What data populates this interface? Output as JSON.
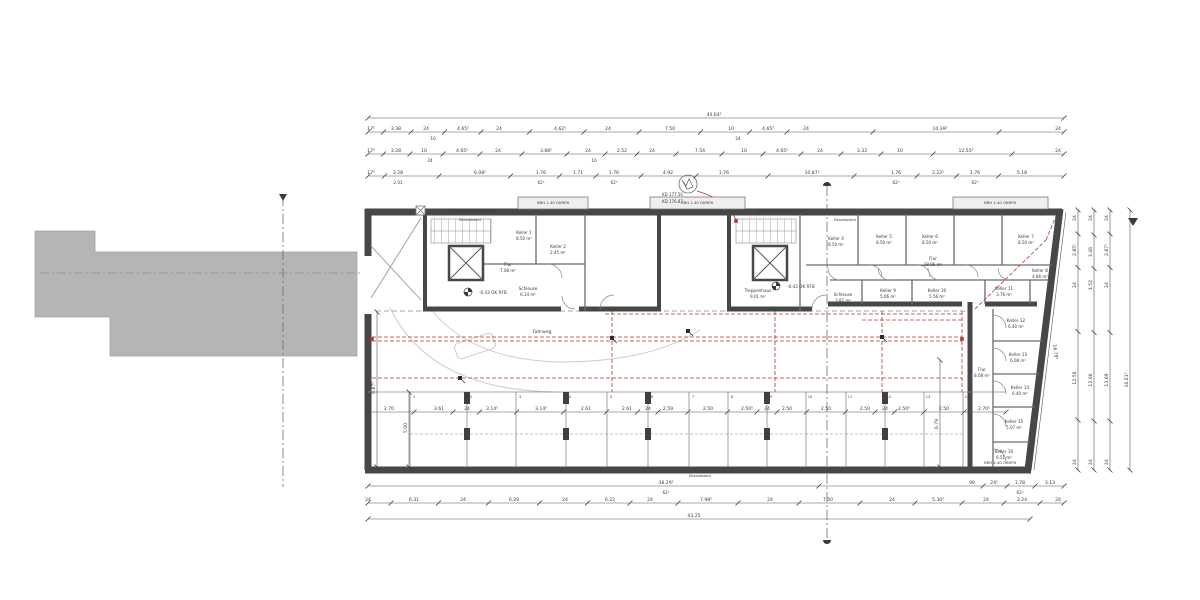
{
  "palette": {
    "wall": "#474747",
    "thin": "#6a6a6a",
    "line": "#8a8a8a",
    "dim_text": "#3a3a3a",
    "red": "#b03a2e",
    "gray_mass": "#b5b5b5",
    "light_arc": "#cccccc",
    "window_fill": "#efefef"
  },
  "rooms": [
    {
      "name": "Keller 1",
      "area": "8.50 m²",
      "x": 524,
      "y": 234
    },
    {
      "name": "Keller 2",
      "area": "2.45 m²",
      "x": 558,
      "y": 248
    },
    {
      "name": "Flur",
      "area": "7.08 m²",
      "x": 508,
      "y": 266
    },
    {
      "name": "Schleuse",
      "area": "6.14 m²",
      "x": 528,
      "y": 290
    },
    {
      "name": "Treppenhaus",
      "area": "9.01 m²",
      "x": 758,
      "y": 292
    },
    {
      "name": "Schleuse",
      "area": "3.87 m²",
      "x": 843,
      "y": 296
    },
    {
      "name": "Keller 4",
      "area": "8.50 m²",
      "x": 836,
      "y": 240
    },
    {
      "name": "Keller 5",
      "area": "8.50 m²",
      "x": 884,
      "y": 238
    },
    {
      "name": "Keller 6",
      "area": "8.50 m²",
      "x": 930,
      "y": 238
    },
    {
      "name": "Keller 7",
      "area": "8.50 m²",
      "x": 1026,
      "y": 238
    },
    {
      "name": "Keller 8",
      "area": "4.86 m²",
      "x": 1040,
      "y": 272
    },
    {
      "name": "Keller 9",
      "area": "5.06 m²",
      "x": 888,
      "y": 292
    },
    {
      "name": "Keller 10",
      "area": "5.56 m²",
      "x": 937,
      "y": 292
    },
    {
      "name": "Keller 11",
      "area": "3.76 m²",
      "x": 1004,
      "y": 290
    },
    {
      "name": "Flur",
      "area": "18.96 m²",
      "x": 933,
      "y": 260
    },
    {
      "name": "Keller 12",
      "area": "6.40 m²",
      "x": 1016,
      "y": 322
    },
    {
      "name": "Keller 13",
      "area": "6.08 m²",
      "x": 1018,
      "y": 356
    },
    {
      "name": "Keller 14",
      "area": "6.40 m²",
      "x": 1020,
      "y": 389
    },
    {
      "name": "Keller 15",
      "area": "5.07 m²",
      "x": 1014,
      "y": 423
    },
    {
      "name": "Keller 16",
      "area": "6.51 m²",
      "x": 1004,
      "y": 453
    },
    {
      "name": "Flur",
      "area": "8.08 m²",
      "x": 982,
      "y": 371
    }
  ],
  "annotations": [
    {
      "t": "Sicherheitstreppenraum",
      "x": 450,
      "y": 212,
      "s": 4.2,
      "a": "start",
      "c": "#4a4a4a"
    },
    {
      "t": "Sicherheitstreppenraum",
      "x": 757,
      "y": 212,
      "s": 4.2,
      "a": "start",
      "c": "#4a4a4a"
    },
    {
      "t": "BRH 1.40 OKRFB",
      "x": 553,
      "y": 204,
      "s": 3.8,
      "a": "middle",
      "c": "#5a5a5a"
    },
    {
      "t": "BRH 1.40 OKRFB",
      "x": 697,
      "y": 204,
      "s": 3.8,
      "a": "middle",
      "c": "#5a5a5a"
    },
    {
      "t": "BRH 1.40 OKRFB",
      "x": 1000,
      "y": 204,
      "s": 3.8,
      "a": "middle",
      "c": "#5a5a5a"
    },
    {
      "t": "BRH 1.40 OKRFB",
      "x": 1000,
      "y": 464,
      "s": 3.8,
      "a": "middle",
      "c": "#5a5a5a"
    },
    {
      "t": "Brandwand",
      "x": 470,
      "y": 221,
      "s": 3.8,
      "a": "middle",
      "c": "#bdbdbd"
    },
    {
      "t": "Brandwand",
      "x": 845,
      "y": 221,
      "s": 3.8,
      "a": "middle",
      "c": "#bdbdbd"
    },
    {
      "t": "Brandwand",
      "x": 700,
      "y": 477,
      "s": 3.8,
      "a": "middle",
      "c": "#bdbdbd"
    },
    {
      "t": "-0.43 OK RFB",
      "x": 479,
      "y": 294,
      "s": 4.2,
      "a": "start",
      "c": "#3a3a3a"
    },
    {
      "t": "-0.43 OK RFB",
      "x": 787,
      "y": 288,
      "s": 4.2,
      "a": "start",
      "c": "#3a3a3a"
    },
    {
      "t": "KD 177.50",
      "x": 662,
      "y": 196,
      "s": 4,
      "a": "start",
      "c": "#b03a2e"
    },
    {
      "t": "KD 176.87",
      "x": 662,
      "y": 203,
      "s": 4,
      "a": "start",
      "c": "#b03a2e"
    },
    {
      "t": "Fahrweg",
      "x": 542,
      "y": 333,
      "s": 4.5,
      "a": "middle",
      "c": "#4a4a4a"
    }
  ],
  "dims": {
    "h_rows": [
      {
        "y": 118,
        "x1": 368,
        "x2": 1064,
        "labels": [
          [
            "44.64⁵",
            714
          ]
        ]
      },
      {
        "y": 132,
        "x1": 368,
        "x2": 1064,
        "labels": [
          [
            "17⁵",
            371
          ],
          [
            "3.38",
            396
          ],
          [
            "24",
            426
          ],
          [
            "4.65⁵",
            463
          ],
          [
            "24",
            499
          ],
          [
            "4.62⁵",
            560
          ],
          [
            "24",
            608
          ],
          [
            "7.50",
            670
          ],
          [
            "10",
            731
          ],
          [
            "4.65⁵",
            768
          ],
          [
            "24",
            806
          ],
          [
            "10.39⁵",
            940
          ],
          [
            "24",
            1058
          ]
        ]
      },
      {
        "y": 154,
        "x1": 368,
        "x2": 1064,
        "labels": [
          [
            "17⁵",
            371
          ],
          [
            "3.28",
            396
          ],
          [
            "10",
            424
          ],
          [
            "4.65⁵",
            462
          ],
          [
            "24",
            498
          ],
          [
            "3.88⁵",
            546
          ],
          [
            "24",
            588
          ],
          [
            "2.52",
            622
          ],
          [
            "24",
            652
          ],
          [
            "7.54",
            700
          ],
          [
            "10",
            744
          ],
          [
            "4.65⁵",
            782
          ],
          [
            "24",
            820
          ],
          [
            "3.33",
            862
          ],
          [
            "10",
            900
          ],
          [
            "12.55⁵",
            966
          ],
          [
            "24",
            1058
          ]
        ]
      },
      {
        "y": 176,
        "x1": 368,
        "x2": 1064,
        "labels": [
          [
            "17⁵",
            371
          ],
          [
            "3.28",
            398
          ],
          [
            "6.08⁵",
            480
          ],
          [
            "1.76",
            541
          ],
          [
            "1.71",
            578
          ],
          [
            "1.76",
            614
          ],
          [
            "4.92",
            668
          ],
          [
            "1.76",
            724
          ],
          [
            "10.87⁵",
            812
          ],
          [
            "1.76",
            896
          ],
          [
            "2.22⁵",
            938
          ],
          [
            "1.76",
            975
          ],
          [
            "5.18",
            1022
          ]
        ]
      },
      {
        "y": 412,
        "x1": 368,
        "x2": 1006,
        "labels": [
          [
            "2.70",
            389
          ],
          [
            "3.61",
            439
          ],
          [
            "24",
            467
          ],
          [
            "3.14⁵",
            492
          ],
          [
            "3.14⁵",
            541
          ],
          [
            "2.61",
            586
          ],
          [
            "2.61",
            627
          ],
          [
            "24",
            648
          ],
          [
            "2.59",
            668
          ],
          [
            "2.50",
            708
          ],
          [
            "2.50⁵",
            747
          ],
          [
            "24",
            767
          ],
          [
            "2.50",
            787
          ],
          [
            "2.50",
            826
          ],
          [
            "2.50",
            865
          ],
          [
            "24",
            885
          ],
          [
            "2.50⁵",
            904
          ],
          [
            "2.50",
            944
          ],
          [
            "2.70⁵",
            984
          ]
        ]
      },
      {
        "y": 486,
        "x1": 368,
        "x2": 1064,
        "labels": [
          [
            "38.29⁵",
            666
          ],
          [
            "98",
            972
          ],
          [
            "24¹",
            994
          ],
          [
            "1.78",
            1020
          ],
          [
            "3.13",
            1050
          ]
        ]
      },
      {
        "y": 503,
        "x1": 368,
        "x2": 1064,
        "labels": [
          [
            "24",
            368
          ],
          [
            "6.31",
            414
          ],
          [
            "24",
            463
          ],
          [
            "6.29",
            514
          ],
          [
            "24",
            565
          ],
          [
            "6.22",
            610
          ],
          [
            "24",
            650
          ],
          [
            "7.98⁵",
            706
          ],
          [
            "24",
            770
          ],
          [
            "7.50",
            828
          ],
          [
            "24",
            892
          ],
          [
            "5.30⁵",
            938
          ],
          [
            "24",
            986
          ],
          [
            "3.24",
            1022
          ],
          [
            "24",
            1058
          ]
        ]
      },
      {
        "y": 519,
        "x1": 368,
        "x2": 1030,
        "labels": [
          [
            "43.25",
            694
          ]
        ]
      }
    ],
    "sub_labels": [
      [
        "10",
        433,
        140
      ],
      [
        "24",
        738,
        140
      ],
      [
        "24",
        430,
        162
      ],
      [
        "10",
        594,
        162
      ],
      [
        "2.01",
        398,
        184
      ],
      [
        "62⁵",
        541,
        184
      ],
      [
        "62⁵",
        614,
        184
      ],
      [
        "62⁵",
        896,
        184
      ],
      [
        "62⁵",
        975,
        184
      ],
      [
        "62⁵",
        666,
        494
      ],
      [
        "62⁵",
        1020,
        494
      ]
    ],
    "v_chains": [
      {
        "x": 1078,
        "y1": 210,
        "y2": 470,
        "labels": [
          [
            "24",
            218
          ],
          [
            "2.85⁵",
            250
          ],
          [
            "24",
            285
          ],
          [
            "12.56",
            378
          ],
          [
            "24",
            462
          ]
        ]
      },
      {
        "x": 1094,
        "y1": 210,
        "y2": 470,
        "labels": [
          [
            "24",
            218
          ],
          [
            "3.46",
            252
          ],
          [
            "1.52",
            285
          ],
          [
            "12.06",
            380
          ],
          [
            "24",
            462
          ]
        ]
      },
      {
        "x": 1110,
        "y1": 210,
        "y2": 470,
        "labels": [
          [
            "24",
            218
          ],
          [
            "2.87⁵",
            250
          ],
          [
            "24",
            285
          ],
          [
            "13.69",
            380
          ],
          [
            "24",
            462
          ]
        ]
      },
      {
        "x": 1130,
        "y1": 210,
        "y2": 470,
        "labels": [
          [
            "16.61⁵",
            380
          ]
        ]
      },
      {
        "x": 377,
        "y1": 312,
        "y2": 467,
        "labels": [
          [
            "9.87⁵",
            388
          ]
        ]
      },
      {
        "x": 409,
        "y1": 392,
        "y2": 467,
        "labels": [
          [
            "5.00",
            428
          ]
        ]
      },
      {
        "x": 940,
        "y1": 360,
        "y2": 467,
        "labels": [
          [
            "6.79",
            424
          ]
        ]
      }
    ],
    "slant_dim": {
      "x1": 1066,
      "y1": 212,
      "x2": 1034,
      "y2": 470,
      "t": "16.79⁵",
      "tx": 1054,
      "ty": 352,
      "rot": 83
    }
  },
  "stalls": {
    "top_y": 392,
    "bot_y": 467,
    "dividers": [
      410,
      467,
      516,
      566,
      607,
      648,
      689,
      728,
      767,
      806,
      846,
      885,
      924,
      963
    ],
    "numbers": [
      "1",
      "2",
      "3",
      "4",
      "5",
      "6",
      "7",
      "8",
      "9",
      "10",
      "11",
      "12",
      "13",
      "14"
    ],
    "columns": [
      467,
      566,
      648,
      767,
      885
    ]
  },
  "markers": {
    "red_squares": [
      [
        372,
        339
      ],
      [
        962,
        339
      ],
      [
        736,
        221
      ]
    ],
    "black_flags": [
      [
        460,
        378
      ],
      [
        612,
        338
      ],
      [
        688,
        331
      ],
      [
        882,
        337
      ]
    ]
  }
}
